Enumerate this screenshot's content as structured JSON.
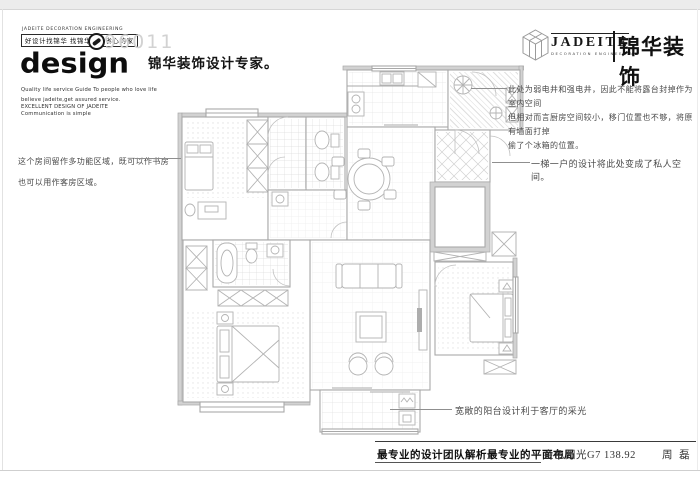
{
  "colors": {
    "plan_line": "#a8a8a8",
    "wall_fill": "#d2d2d2",
    "text_dark": "#141414",
    "note_text": "#4a4a4a",
    "hotline_gray": "#d2d2d2",
    "page_border": "#cfcfcf"
  },
  "header": {
    "logo_left": {
      "eng_line": "JADEITE DECORATION ENGINEERING",
      "slogan_box": "好设计找锦华 找锦华装饰省心的家",
      "hotline": "96011",
      "wordmark": "design",
      "taglines": [
        "Quality life service Guide To people who love life",
        "believe jadeite,get assured service.",
        "EXCELLENT DESIGN OF JADEITE",
        "Communication is simple"
      ]
    },
    "title": "锦华装饰设计专家。",
    "logo_right": {
      "en": "JADEITE",
      "en_sub": "DECORATION ENGINEERING",
      "zh": "锦华装饰"
    }
  },
  "annotations": {
    "left_note": [
      "这个房间留作多功能区域，既可以作书房",
      "也可以用作客房区域。"
    ],
    "shaft_note": [
      "此处为弱电井和强电井，因此不能将露台封掉作为室内空间",
      "但相对而言厨房空间较小，移门位置也不够，将原有墙面打掉",
      "偷了个冰箱的位置。"
    ],
    "private_note": "一梯一户的设计将此处变成了私人空间。",
    "balcony_note": "宽敞的阳台设计利于客厅的采光"
  },
  "footer": {
    "slogan": "最专业的设计团队解析最专业的平面布局",
    "project": "金色阳光G7 138.92",
    "designer": "周 磊"
  }
}
